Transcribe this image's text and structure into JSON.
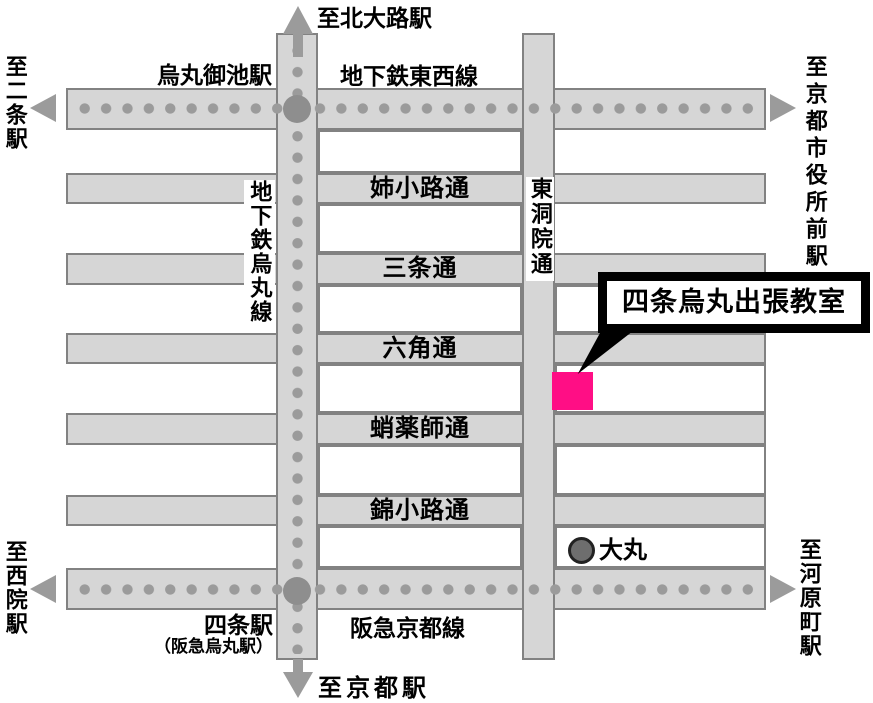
{
  "colors": {
    "street_fill": "#d6d6d6",
    "street_border": "#828282",
    "block_fill": "#ffffff",
    "rail_dot": "#9b9b9b",
    "station_dot": "#8e8e8e",
    "arrow": "#9b9b9b",
    "highlight_pink": "#ff0e85",
    "daimaru_fill": "#6e6e6e",
    "callout_border": "#000000",
    "text": "#000000"
  },
  "icons": {
    "north_arrow": "css-triangle-up",
    "south_arrow": "css-triangle-down",
    "west_arrow": "css-triangle-left",
    "east_arrow": "css-triangle-right",
    "subway_line": "gray-dotted-line",
    "station_marker": "gray-filled-circle",
    "classroom_marker": "pink-square",
    "daimaru_marker": "dark-gray-circle"
  },
  "edges": {
    "north": {
      "label": "至北大路駅"
    },
    "south": {
      "label": "至京都駅"
    },
    "west_top": {
      "label": "至二条駅"
    },
    "west_bottom": {
      "label": "至西院駅"
    },
    "east_top": {
      "label": "至京都市役所前駅"
    },
    "east_bottom": {
      "label": "至河原町駅"
    }
  },
  "railways": {
    "tozai": {
      "label": "地下鉄東西線"
    },
    "karasuma": {
      "label": "地下鉄烏丸線"
    },
    "hankyu": {
      "label": "阪急京都線"
    }
  },
  "stations": {
    "karasuma_oike": {
      "label": "烏丸御池駅"
    },
    "shijo": {
      "label": "四条駅",
      "sublabel": "（阪急烏丸駅）"
    }
  },
  "streets": {
    "aneyakoji": {
      "label": "姉小路通"
    },
    "sanjo": {
      "label": "三条通"
    },
    "rokkaku": {
      "label": "六角通"
    },
    "takoyakushi": {
      "label": "蛸薬師通"
    },
    "nishikikoji": {
      "label": "錦小路通"
    },
    "higashinotoin": {
      "label": "東洞院通"
    }
  },
  "landmarks": {
    "daimaru": {
      "label": "大丸"
    },
    "classroom": {
      "label": "四条烏丸出張教室"
    }
  }
}
